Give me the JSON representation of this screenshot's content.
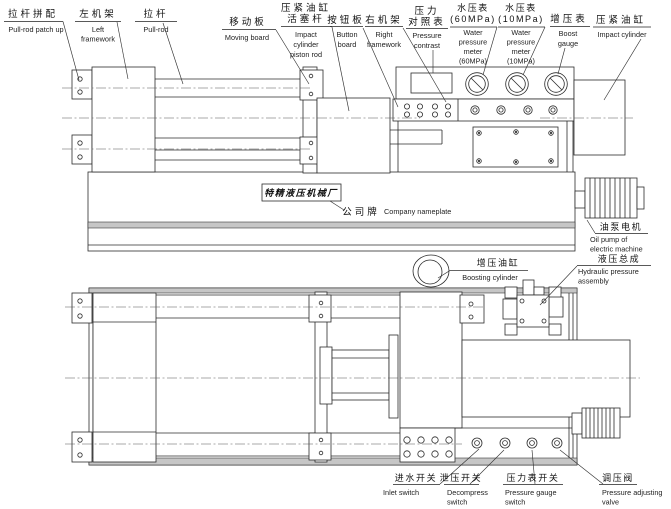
{
  "diagram": {
    "title_hint": "Hydraulic press machine two-view engineering drawing",
    "labels": {
      "pull_rod_patch_up": {
        "zh": "拉杆拼配",
        "en": "Pull-rod patch up"
      },
      "left_framework": {
        "zh": "左机架",
        "en": "Left\nframework"
      },
      "pull_rod": {
        "zh": "拉杆",
        "en": "Pull-rod"
      },
      "moving_board": {
        "zh": "移动板",
        "en": "Moving board"
      },
      "impact_cylinder_piston_rod": {
        "zh": "压紧油缸\n活塞杆",
        "en": "Impact\ncylinder\npiston rod"
      },
      "button_board": {
        "zh": "按钮板",
        "en": "Button\nboard"
      },
      "right_framework": {
        "zh": "右机架",
        "en": "Right\nframework"
      },
      "pressure_contrast": {
        "zh": "压力\n对照表",
        "en": "Pressure\ncontrast"
      },
      "water_pressure_meter_60": {
        "zh": "水压表\n(60MPa)",
        "en": "Water\npressure\nmeter\n(60MPa)"
      },
      "water_pressure_meter_10": {
        "zh": "水压表\n(10MPa)",
        "en": "Water\npressure\nmeter\n(10MPa)"
      },
      "boost_gauge": {
        "zh": "增压表",
        "en": "Boost\ngauge"
      },
      "impact_cylinder": {
        "zh": "压紧油缸",
        "en": "Impact cylinder"
      },
      "company_nameplate": {
        "zh": "公司牌",
        "en": "Company nameplate",
        "plate_text": "特精液压机械厂"
      },
      "oil_pump": {
        "zh": "油泵电机",
        "en": "Oil pump of\nelectric machine"
      },
      "boosting_cylinder": {
        "zh": "增压油缸",
        "en": "Boosting cylinder"
      },
      "hydraulic_assembly": {
        "zh": "液压总成",
        "en": "Hydraulic pressure\nassembly"
      },
      "inlet_switch": {
        "zh": "进水开关",
        "en": "Inlet switch"
      },
      "decompress_switch": {
        "zh": "泄压开关",
        "en": "Decompress\nswitch"
      },
      "pressure_gauge_switch": {
        "zh": "压力表开关",
        "en": "Pressure gauge\nswitch"
      },
      "pressure_adjusting_valve": {
        "zh": "调压阀",
        "en": "Pressure adjusting\nvalve"
      }
    }
  }
}
